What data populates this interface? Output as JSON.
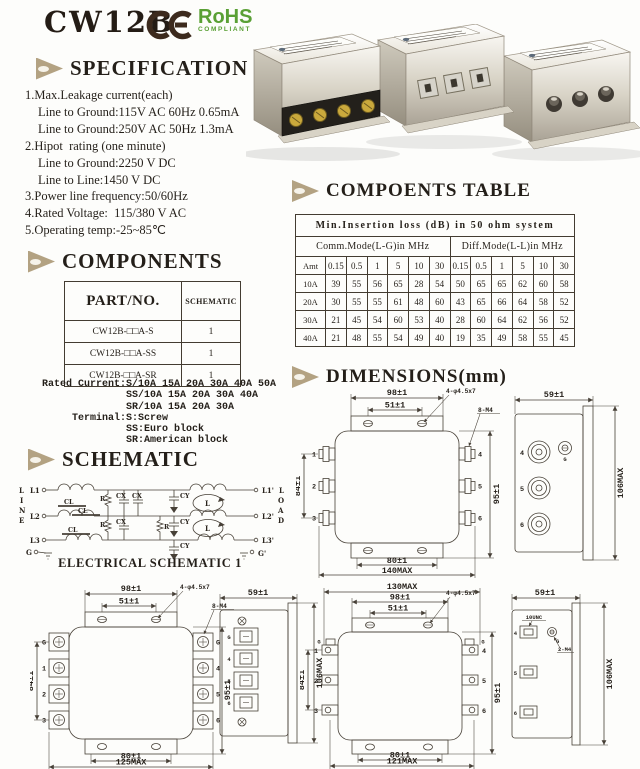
{
  "header": {
    "title": "CW12B",
    "rohs_line1": "RoHS",
    "rohs_line2": "COMPLIANT",
    "rohs_color": "#5aa035",
    "ce_color": "#3c2a1d",
    "bullet_color": "#b3a282"
  },
  "specification": {
    "title": "SPECIFICATION",
    "items": [
      {
        "text": "1.Max.Leakage current(each)",
        "indent": 0
      },
      {
        "text": "Line to Ground:115V AC 60Hz 0.65mA",
        "indent": 1
      },
      {
        "text": "Line to Ground:250V AC 50Hz 1.3mA",
        "indent": 1
      },
      {
        "text": "2.Hipot  rating (one minute)",
        "indent": 0
      },
      {
        "text": "Line to Ground:2250 V DC",
        "indent": 1
      },
      {
        "text": "Line to Line:1450 V DC",
        "indent": 1
      },
      {
        "text": "3.Power line frequency:50/60Hz",
        "indent": 0
      },
      {
        "text": "4.Rated Voltage:  115/380 V AC",
        "indent": 0
      },
      {
        "text": "5.Operating temp:-25~85℃",
        "indent": 0
      }
    ]
  },
  "components": {
    "title": "COMPONENTS",
    "table": {
      "col1": "PART/NO.",
      "col2": "SCHEMATIC",
      "rows": [
        {
          "part": "CW12B-□□A-S",
          "schematic": "1"
        },
        {
          "part": "CW12B-□□A-SS",
          "schematic": "1"
        },
        {
          "part": "CW12B-□□A-SR",
          "schematic": "1"
        }
      ]
    },
    "notes": [
      "Rated Current:S/10A 15A 20A 30A 40A 50A",
      "              SS/10A 15A 20A 30A 40A",
      "              SR/10A 15A 20A 30A",
      "     Terminal:S:Screw",
      "              SS:Euro block",
      "              SR:American block"
    ]
  },
  "insertion_table": {
    "section_title": "COMPOENTS TABLE",
    "title": "Min.Insertion loss (dB) in 50 ohm system",
    "group1": "Comm.Mode(L-G)in MHz",
    "group2": "Diff.Mode(L-L)in MHz",
    "corner": "Amt",
    "freqs": [
      "0.15",
      "0.5",
      "1",
      "5",
      "10",
      "30",
      "0.15",
      "0.5",
      "1",
      "5",
      "10",
      "30"
    ],
    "rows": [
      {
        "amt": "10A",
        "values": [
          "39",
          "55",
          "56",
          "65",
          "28",
          "54",
          "50",
          "65",
          "65",
          "62",
          "60",
          "58"
        ]
      },
      {
        "amt": "20A",
        "values": [
          "30",
          "55",
          "55",
          "61",
          "48",
          "60",
          "43",
          "65",
          "66",
          "64",
          "58",
          "52"
        ]
      },
      {
        "amt": "30A",
        "values": [
          "21",
          "45",
          "54",
          "60",
          "53",
          "40",
          "28",
          "60",
          "64",
          "62",
          "56",
          "52"
        ]
      },
      {
        "amt": "40A",
        "values": [
          "21",
          "48",
          "55",
          "54",
          "49",
          "40",
          "19",
          "35",
          "49",
          "58",
          "55",
          "45"
        ]
      }
    ]
  },
  "schematic": {
    "title": "SCHEMATIC",
    "caption": "ELECTRICAL SCHEMATIC 1",
    "line_word": [
      "L",
      "I",
      "N",
      "E"
    ],
    "load_word": [
      "L",
      "O",
      "A",
      "D"
    ],
    "left": [
      "L1",
      "L2",
      "L3",
      "G"
    ],
    "right": [
      "L1'",
      "L2'",
      "L3'",
      "G'"
    ],
    "cl": "CL",
    "r": "R",
    "cx": "CX",
    "cy": "CY",
    "l": "L"
  },
  "dimensions": {
    "title": "DIMENSIONS(mm)",
    "drawing1": {
      "top_width": "98±1",
      "inner_width": "51±1",
      "left_height": "84±1",
      "right_height": "95±1",
      "bottom_inner": "80±1",
      "bottom_total": "140MAX",
      "callout_holes": "4-φ4.5x7",
      "callout_threads": "8-M4",
      "lt": [
        "1",
        "2",
        "3"
      ],
      "rt": [
        "4",
        "5",
        "6"
      ],
      "side": {
        "width": "59±1",
        "height": "106MAX",
        "t": [
          "4",
          "5",
          "6"
        ],
        "g": "G"
      }
    },
    "drawing2": {
      "top_width": "98±1",
      "inner_width": "51±1",
      "left_height": "84±1",
      "right_height": "95±1",
      "bottom_inner": "80±1",
      "bottom_total": "125MAX",
      "callout_holes": "4-φ4.5x7",
      "callout_threads": "8-M4",
      "lt": [
        "G",
        "1",
        "2",
        "3"
      ],
      "rt": [
        "G",
        "4",
        "5",
        "6"
      ],
      "side": {
        "width": "59±1",
        "height": "106MAX",
        "t": [
          "G",
          "4",
          "5",
          "6"
        ]
      }
    },
    "drawing3": {
      "top_total": "130MAX",
      "top_width": "98±1",
      "inner_width": "51±1",
      "left_height": "84±1",
      "right_height": "95±1",
      "bottom_inner": "80±1",
      "bottom_total": "121MAX",
      "callout_holes": "4-φ4.5x7",
      "lg": "G",
      "rg": "G",
      "lt": [
        "1",
        "2",
        "3"
      ],
      "rt": [
        "4",
        "5",
        "6"
      ],
      "side": {
        "width": "59±1",
        "height": "106MAX",
        "t": [
          "4",
          "5",
          "6"
        ],
        "g": "G",
        "callout_tab": "10UNC",
        "callout_screw": "2-M4"
      }
    }
  }
}
